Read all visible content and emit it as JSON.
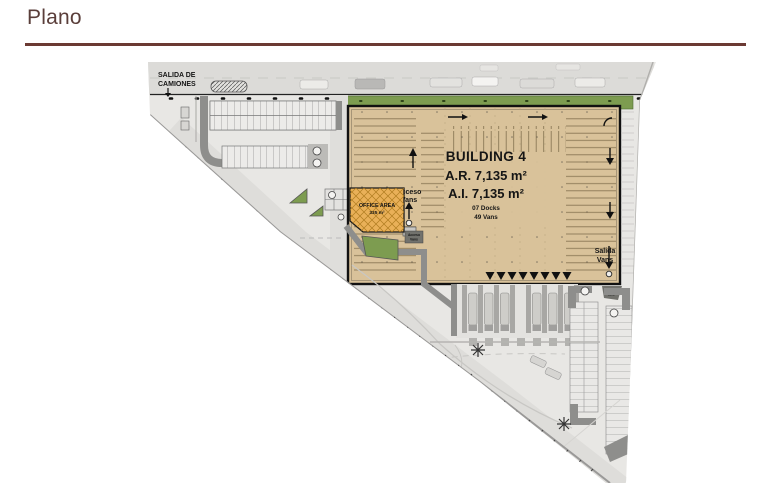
{
  "page": {
    "title": "Plano"
  },
  "plan": {
    "colors": {
      "accent_maroon": "#6b3a33",
      "building_tan": "#d9c29a",
      "office_orange": "#e9b058",
      "landscape_green": "#7d9c50",
      "ground_gray": "#e8e7e4",
      "aisle_dark_gray": "#8e8e8c"
    },
    "salida_camiones": {
      "line1": "SALIDA DE",
      "line2": "CAMIONES"
    },
    "building": {
      "name": "BUILDING 4",
      "ar": "A.R. 7,135 m²",
      "ai": "A.I.  7,135 m²",
      "docks": "07 Docks",
      "vans": "49 Vans"
    },
    "office": {
      "label": "OFFICE AREA",
      "area": "335 m²"
    },
    "acceso_vans": {
      "line1": "Acceso",
      "line2": "Vans"
    },
    "salida_vans": {
      "line1": "Salida",
      "line2": "Vans"
    }
  }
}
